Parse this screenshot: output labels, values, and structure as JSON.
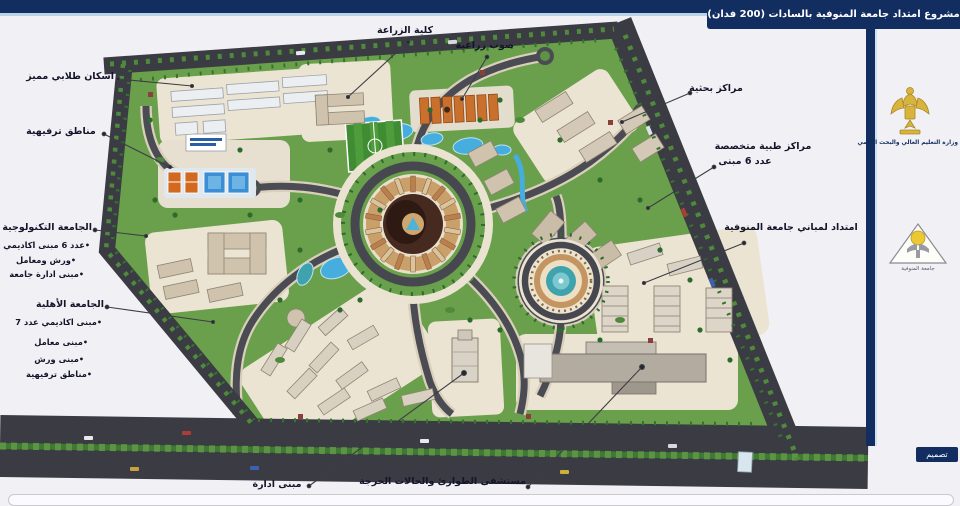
{
  "frame": {
    "title": "مشروع امتداد جامعة المنوفية بالسادات (200 فدان)",
    "ministry": "وزارة التعليم العالي والبحث العلمي",
    "university_logo_caption": "جامعة المنوفية",
    "design_credit": "تصميم"
  },
  "labels": {
    "student_housing": "اسكان طلابي مميز",
    "recreation_top": "مناطق ترفيهية",
    "tech_university": "الجامعة التكنولوجية",
    "tech_item_academic": "عدد 6 مبنى اكاديمي",
    "tech_item_workshops": "ورش ومعامل",
    "tech_item_admin": "مبنى ادارة جامعة",
    "ahlia_university": "الجامعة الأهلية",
    "ahlia_item_academic": "مبنى اكاديمي عدد 7",
    "ahlia_item_labs": "مبنى معامل",
    "ahlia_item_workshops": "مبنى ورش",
    "ahlia_item_recreation": "مناطق ترفيهية",
    "agriculture_faculty": "كلية الزراعة",
    "greenhouses": "صوب زراعية",
    "research_centers": "مراكز بحثية",
    "medical_centers_line1": "مراكز طبية متخصصة",
    "medical_centers_line2": "عدد 6 مبنى",
    "menoufia_extension": "امتداد لمباني جامعة المنوفية",
    "admin_building": "مبنى ادارة",
    "emergency_hospital": "مستشفى الطوارئ والحالات الحرجة"
  },
  "colors": {
    "navy": "#122d5f",
    "bg": "#f1f1f5",
    "accent_line": "#b9d3e6",
    "label": "#14142a",
    "road": "#45454d",
    "grass": "#6aa04c",
    "cream": "#ece4d2",
    "water": "#45aede",
    "greenhouse": "#c9712c",
    "gold": "#d9b43a"
  }
}
